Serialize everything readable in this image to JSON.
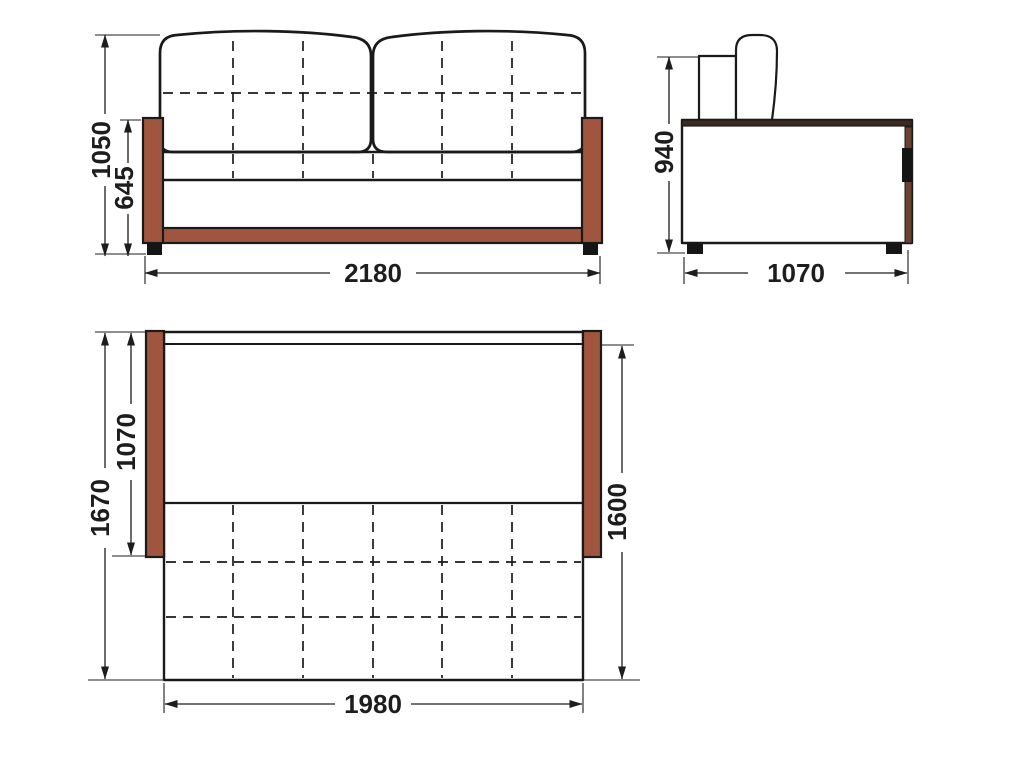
{
  "drawing": {
    "front_view": {
      "dim_total_height": "1050",
      "dim_armrest_height": "645",
      "dim_width": "2180"
    },
    "side_view": {
      "dim_height": "940",
      "dim_depth": "1070"
    },
    "plan_view": {
      "dim_total_length": "1670",
      "dim_seat_depth": "1070",
      "dim_bed_length": "1600",
      "dim_bed_width": "1980"
    }
  },
  "colors": {
    "wood": "#a0563e",
    "wood_dark": "#3c2a1f",
    "wood_edge": "#6b4130",
    "line": "#1a1a1a",
    "bg": "#ffffff"
  }
}
